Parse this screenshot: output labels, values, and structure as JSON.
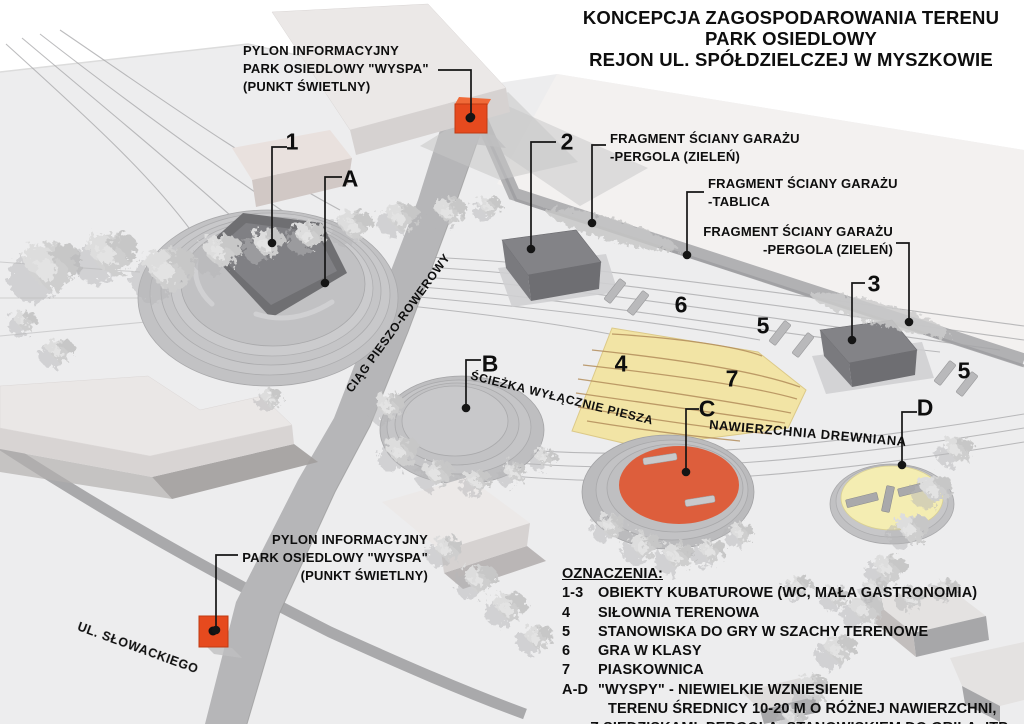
{
  "title": {
    "line1": "KONCEPCJA ZAGOSPODAROWANIA TERENU",
    "line2": "PARK OSIEDLOWY",
    "line3": "REJON UL. SPÓŁDZIELCZEJ W MYSZKOWIE"
  },
  "labels": {
    "pylon_top": {
      "line1": "PYLON INFORMACYJNY",
      "line2": "PARK OSIEDLOWY \"WYSPA\"",
      "line3": "(PUNKT ŚWIETLNY)"
    },
    "pylon_bottom": {
      "line1": "PYLON INFORMACYJNY",
      "line2": "PARK OSIEDLOWY \"WYSPA\"",
      "line3": "(PUNKT ŚWIETLNY)"
    },
    "garage_pergola_1": {
      "line1": "FRAGMENT ŚCIANY GARAŻU",
      "line2": "-PERGOLA (ZIELEŃ)"
    },
    "garage_tablica": {
      "line1": "FRAGMENT ŚCIANY GARAŻU",
      "line2": "-TABLICA"
    },
    "garage_pergola_2": {
      "line1": "FRAGMENT ŚCIANY GARAŻU",
      "line2": "-PERGOLA (ZIELEŃ)"
    },
    "path_bike": "CIĄG PIESZO-ROWEROWY",
    "path_pedestrian": "ŚCIEŻKA WYŁĄCZNIE PIESZA",
    "wooden_surface": "NAWIERZCHNIA DREWNIANA",
    "street": "UL. SŁOWACKIEGO"
  },
  "markers": {
    "n1": "1",
    "n2": "2",
    "n3": "3",
    "n4": "4",
    "n5": "5",
    "n6": "6",
    "n7": "7",
    "a": "A",
    "b": "B",
    "c": "C",
    "d": "D"
  },
  "legend": {
    "heading": "OZNACZENIA:",
    "items": [
      {
        "key": "1-3",
        "text": "OBIEKTY KUBATUROWE (WC, MAŁA GASTRONOMIA)"
      },
      {
        "key": "4",
        "text": "SIŁOWNIA TERENOWA"
      },
      {
        "key": "5",
        "text": "STANOWISKA DO GRY W SZACHY TERENOWE"
      },
      {
        "key": "6",
        "text": "GRA W KLASY"
      },
      {
        "key": "7",
        "text": "PIASKOWNICA"
      },
      {
        "key": "A-D",
        "text": "\"WYSPY\" - NIEWIELKIE WZNIESIENIE"
      }
    ],
    "continuation": [
      "TERENU ŚREDNICY 10-20 M O RÓŻNEJ NAWIERZCHNI,",
      "Z SIEDZISKAMI, PERGOLĄ, STANOWISKIEM DO GRILA, ITP."
    ]
  },
  "colors": {
    "pylon_red": "#e64a1e",
    "fitness_zone_yellow": "#f2e4a5",
    "island_c_orange": "#dd5e3c",
    "island_d_yellow": "#f4edb2"
  }
}
